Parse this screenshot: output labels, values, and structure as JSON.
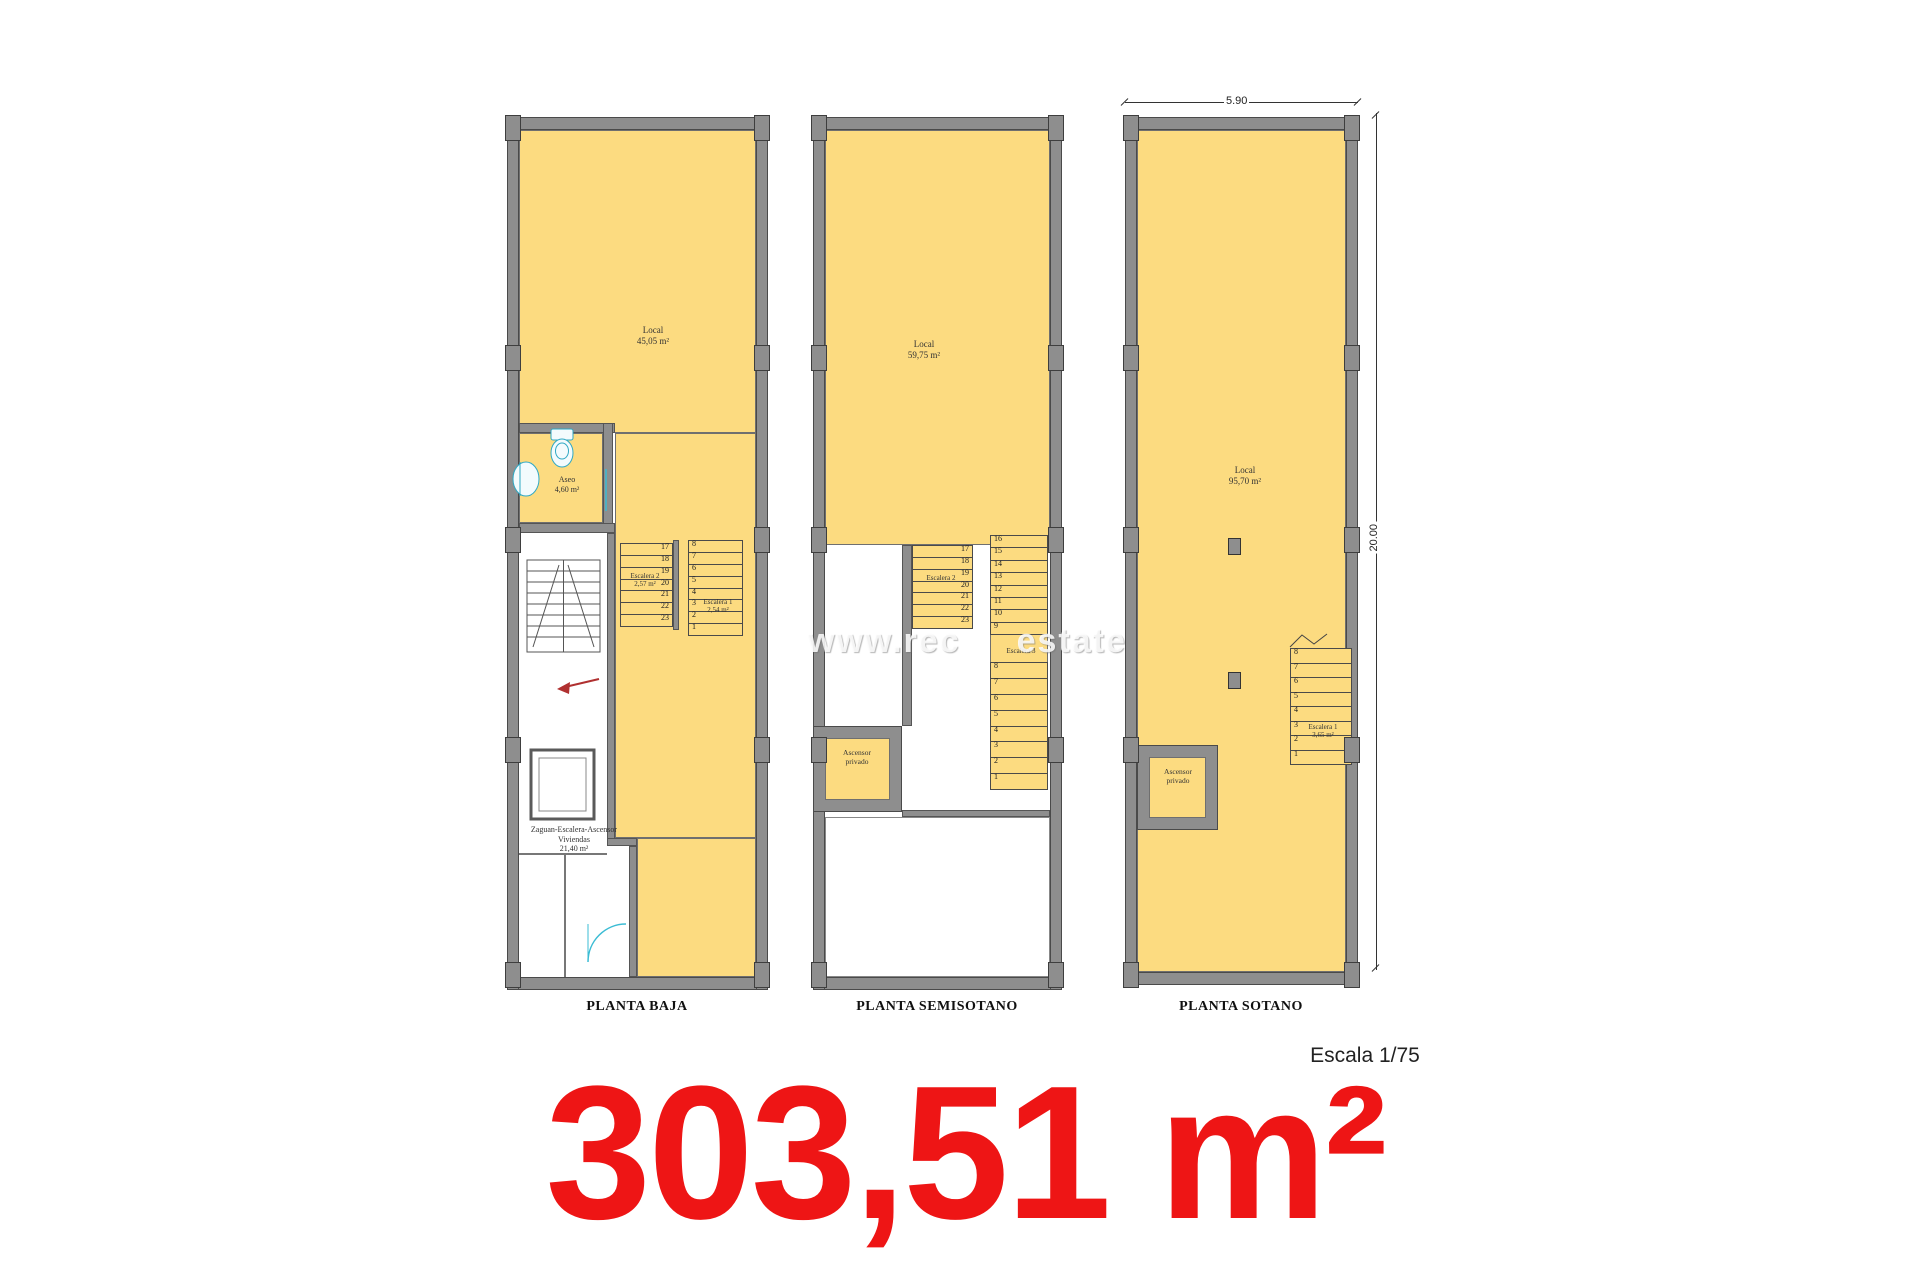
{
  "sheet": {
    "area_total": "303,51 m²",
    "scale_label": "Escala 1/75",
    "watermark_left": "www.rec",
    "watermark_right": "estate"
  },
  "colors": {
    "floor_fill": "#fcdb80",
    "wall_gray": "#8e8e8e",
    "total_red": "#ee1515",
    "fixture_cyan": "#2fa8c4"
  },
  "plans": [
    {
      "name": "PLANTA BAJA",
      "local": {
        "label": "Local",
        "area": "45,05 m²"
      },
      "aseo": {
        "label": "Aseo",
        "area": "4,60 m²"
      },
      "zaguan": {
        "line1": "Zaguan-Escalera-Ascensor",
        "line2": "Viviendas",
        "area": "21,40 m²"
      },
      "escalera2": {
        "label": "Escalera 2",
        "area": "2,57 m²",
        "treads": [
          "17",
          "18",
          "19",
          "20",
          "21",
          "22",
          "23"
        ]
      },
      "escalera1": {
        "label": "Escalera 1",
        "area": "2,54 m²",
        "treads": [
          "8",
          "7",
          "6",
          "5",
          "4",
          "3",
          "2",
          "1"
        ]
      }
    },
    {
      "name": "PLANTA SEMISOTANO",
      "local": {
        "label": "Local",
        "area": "59,75 m²"
      },
      "escalera2": {
        "label": "Escalera 2",
        "treads": [
          "17",
          "18",
          "19",
          "20",
          "21",
          "22",
          "23"
        ]
      },
      "escalera3": {
        "label": "Escalera 3",
        "treads_upper": [
          "16",
          "15",
          "14",
          "13",
          "12",
          "11",
          "10",
          "9"
        ],
        "treads_lower": [
          "8",
          "7",
          "6",
          "5",
          "4",
          "3",
          "2",
          "1"
        ]
      },
      "ascensor": {
        "line1": "Ascensor",
        "line2": "privado"
      }
    },
    {
      "name": "PLANTA SOTANO",
      "dim_width": "5.90",
      "dim_height": "20.00",
      "local": {
        "label": "Local",
        "area": "95,70 m²"
      },
      "escalera1": {
        "label": "Escalera 1",
        "area": "3,65 m²",
        "treads": [
          "8",
          "7",
          "6",
          "5",
          "4",
          "3",
          "2",
          "1"
        ]
      },
      "ascensor": {
        "line1": "Ascensor",
        "line2": "privado"
      }
    }
  ]
}
